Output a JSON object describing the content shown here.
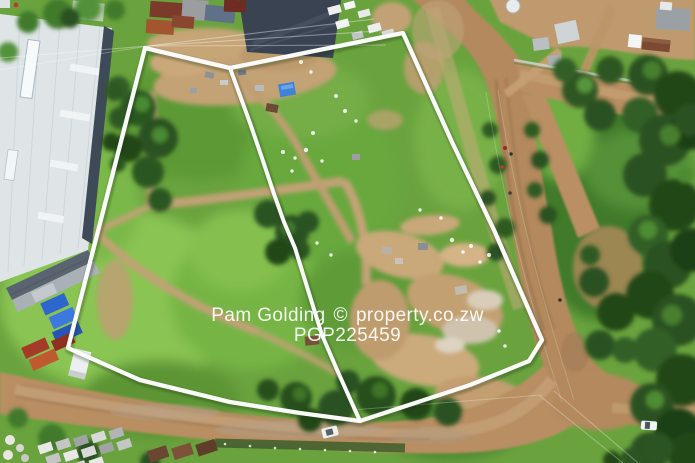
{
  "watermark": {
    "brand": "Pam Golding",
    "copyright_symbol": "©",
    "site": "property.co.zw",
    "reference": "PGP225459"
  },
  "colors": {
    "plot_boundary": "#ffffff",
    "watermark_text": "#ffffff",
    "grass_base": "#6aa33e",
    "dirt_road": "#b3895d",
    "warehouse_roof": "#dfe5e7",
    "dark_roof": "#3a4352",
    "tree_canopy": "#2b5121",
    "container_blue": "#2d66cf",
    "container_orange": "#bf5a2f"
  }
}
